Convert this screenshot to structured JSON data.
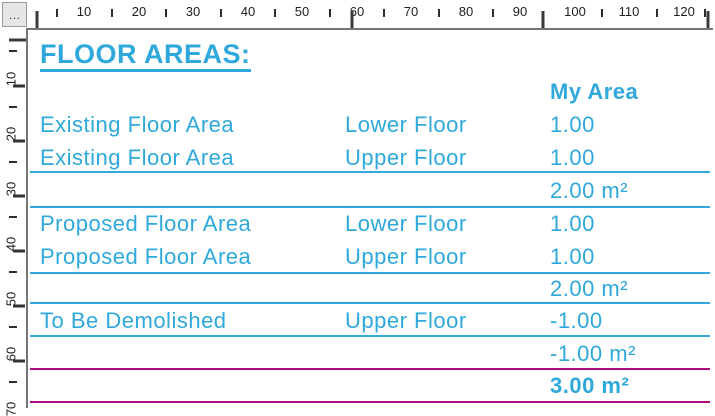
{
  "colors": {
    "accent": "#2fa8db",
    "total-line": "#b00d7c",
    "ruler-ink": "#1e1e1e",
    "border-gray": "#757575"
  },
  "window": {
    "corner_button_label": "…"
  },
  "rulers": {
    "horizontal": {
      "unit_labels": [
        {
          "text": "10",
          "x": 84
        },
        {
          "text": "20",
          "x": 139
        },
        {
          "text": "30",
          "x": 193
        },
        {
          "text": "40",
          "x": 248
        },
        {
          "text": "50",
          "x": 302
        },
        {
          "text": "60",
          "x": 357
        },
        {
          "text": "70",
          "x": 411
        },
        {
          "text": "80",
          "x": 466
        },
        {
          "text": "90",
          "x": 520
        },
        {
          "text": "100",
          "x": 575
        },
        {
          "text": "110",
          "x": 629
        },
        {
          "text": "120",
          "x": 684
        }
      ],
      "minor_ticks": [
        57,
        112,
        166,
        221,
        275,
        330,
        384,
        439,
        493,
        602,
        657,
        705
      ],
      "block_ticks": [
        37,
        352,
        543,
        708
      ]
    },
    "vertical": {
      "unit_labels": [
        {
          "text": "10",
          "y": 79
        },
        {
          "text": "20",
          "y": 134
        },
        {
          "text": "30",
          "y": 189
        },
        {
          "text": "40",
          "y": 244
        },
        {
          "text": "50",
          "y": 299
        },
        {
          "text": "60",
          "y": 354
        },
        {
          "text": "70",
          "y": 409
        }
      ],
      "minor_ticks": [
        51,
        107,
        162,
        217,
        272,
        327,
        382
      ],
      "label_ticks": [
        86,
        141,
        196,
        251,
        306,
        361
      ],
      "block_ticks": [
        40
      ]
    }
  },
  "document": {
    "title": "FLOOR AREAS:",
    "header": {
      "my_area": "My Area"
    },
    "rows": [
      {
        "c1": "Existing Floor Area",
        "c2": "Lower Floor",
        "c3": "1.00"
      },
      {
        "c1": "Existing Floor Area",
        "c2": "Upper Floor",
        "c3": "1.00"
      },
      {
        "c1": "",
        "c2": "",
        "c3": "2.00 m²"
      },
      {
        "c1": "Proposed Floor Area",
        "c2": "Lower Floor",
        "c3": "1.00"
      },
      {
        "c1": "Proposed Floor Area",
        "c2": "Upper Floor",
        "c3": "1.00"
      },
      {
        "c1": "",
        "c2": "",
        "c3": "2.00 m²"
      },
      {
        "c1": "To Be Demolished",
        "c2": "Upper Floor",
        "c3": "-1.00"
      },
      {
        "c1": "",
        "c2": "",
        "c3": "-1.00 m²"
      },
      {
        "c1": "",
        "c2": "",
        "c3": "3.00 m²"
      }
    ]
  }
}
